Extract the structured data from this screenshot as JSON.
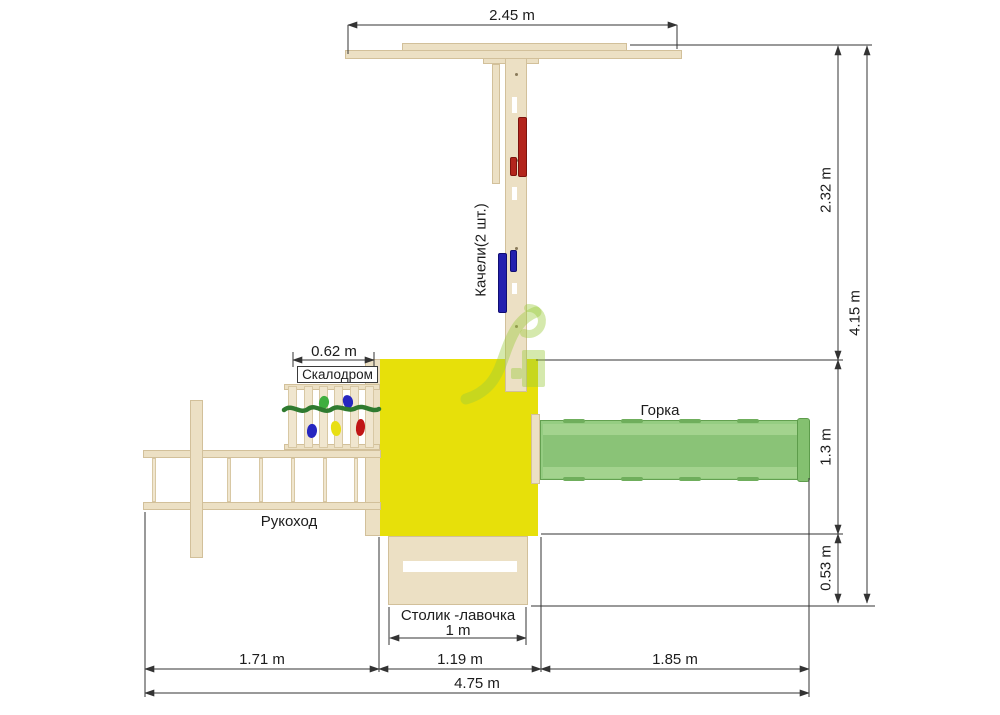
{
  "labels": {
    "swings": "Качели(2 шт.)",
    "climbing_wall": "Скалодром",
    "slide": "Горка",
    "monkey_bars": "Рукоход",
    "table_bench": "Столик -лавочка"
  },
  "dimensions": {
    "beam_width": "2.45 m",
    "upper_height": "2.32 m",
    "total_height": "4.15 m",
    "platform_depth": "1.3 m",
    "table_depth": "0.53 m",
    "climbing_wall_width": "0.62 m",
    "table_width": "1 m",
    "monkey_bars_length": "1.71 m",
    "platform_width": "1.19 m",
    "slide_length": "1.85 m",
    "total_width": "4.75 m"
  },
  "colors": {
    "wood": "#ece0c4",
    "platform_yellow": "#e7e00a",
    "slide_green": "#95cd82",
    "swing_red": "#b3251c",
    "swing_blue": "#2320af",
    "rope_green": "#2f7a2f",
    "watermark_green": "#9acb3c",
    "dimension_line": "#333333"
  }
}
